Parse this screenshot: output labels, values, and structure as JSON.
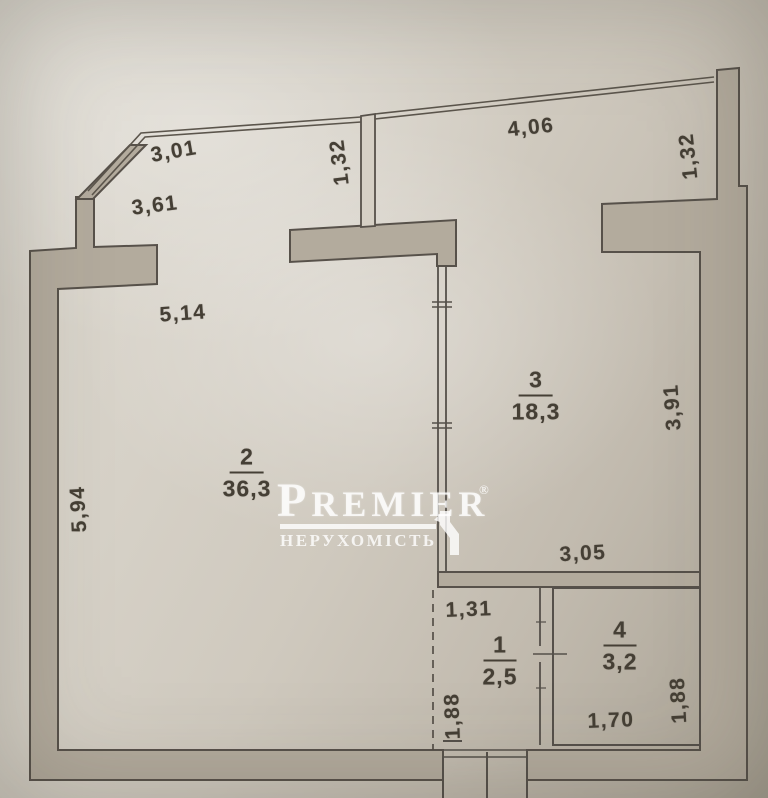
{
  "watermark": {
    "brand": "PREMIER",
    "registered_mark": "®",
    "subtitle": "НЕРУХОМІСТЬ"
  },
  "rooms": [
    {
      "number": "2",
      "area": "36,3"
    },
    {
      "number": "3",
      "area": "18,3"
    },
    {
      "number": "1",
      "area": "2,5"
    },
    {
      "number": "4",
      "area": "3,2"
    }
  ],
  "dimensions": {
    "balcony_left_top": "3,01",
    "balcony_left_wall": "3,61",
    "balcony_divider_depth": "1,32",
    "balcony_right_top": "4,06",
    "balcony_right_depth": "1,32",
    "room2_top_width": "5,14",
    "room2_left_height": "5,94",
    "room3_right_height": "3,91",
    "room3_bottom_width": "3,05",
    "hallway_top_width": "1,31",
    "hallway_left_height": "1,88",
    "room4_bottom_width": "1,70",
    "room4_right_height": "1,88"
  }
}
